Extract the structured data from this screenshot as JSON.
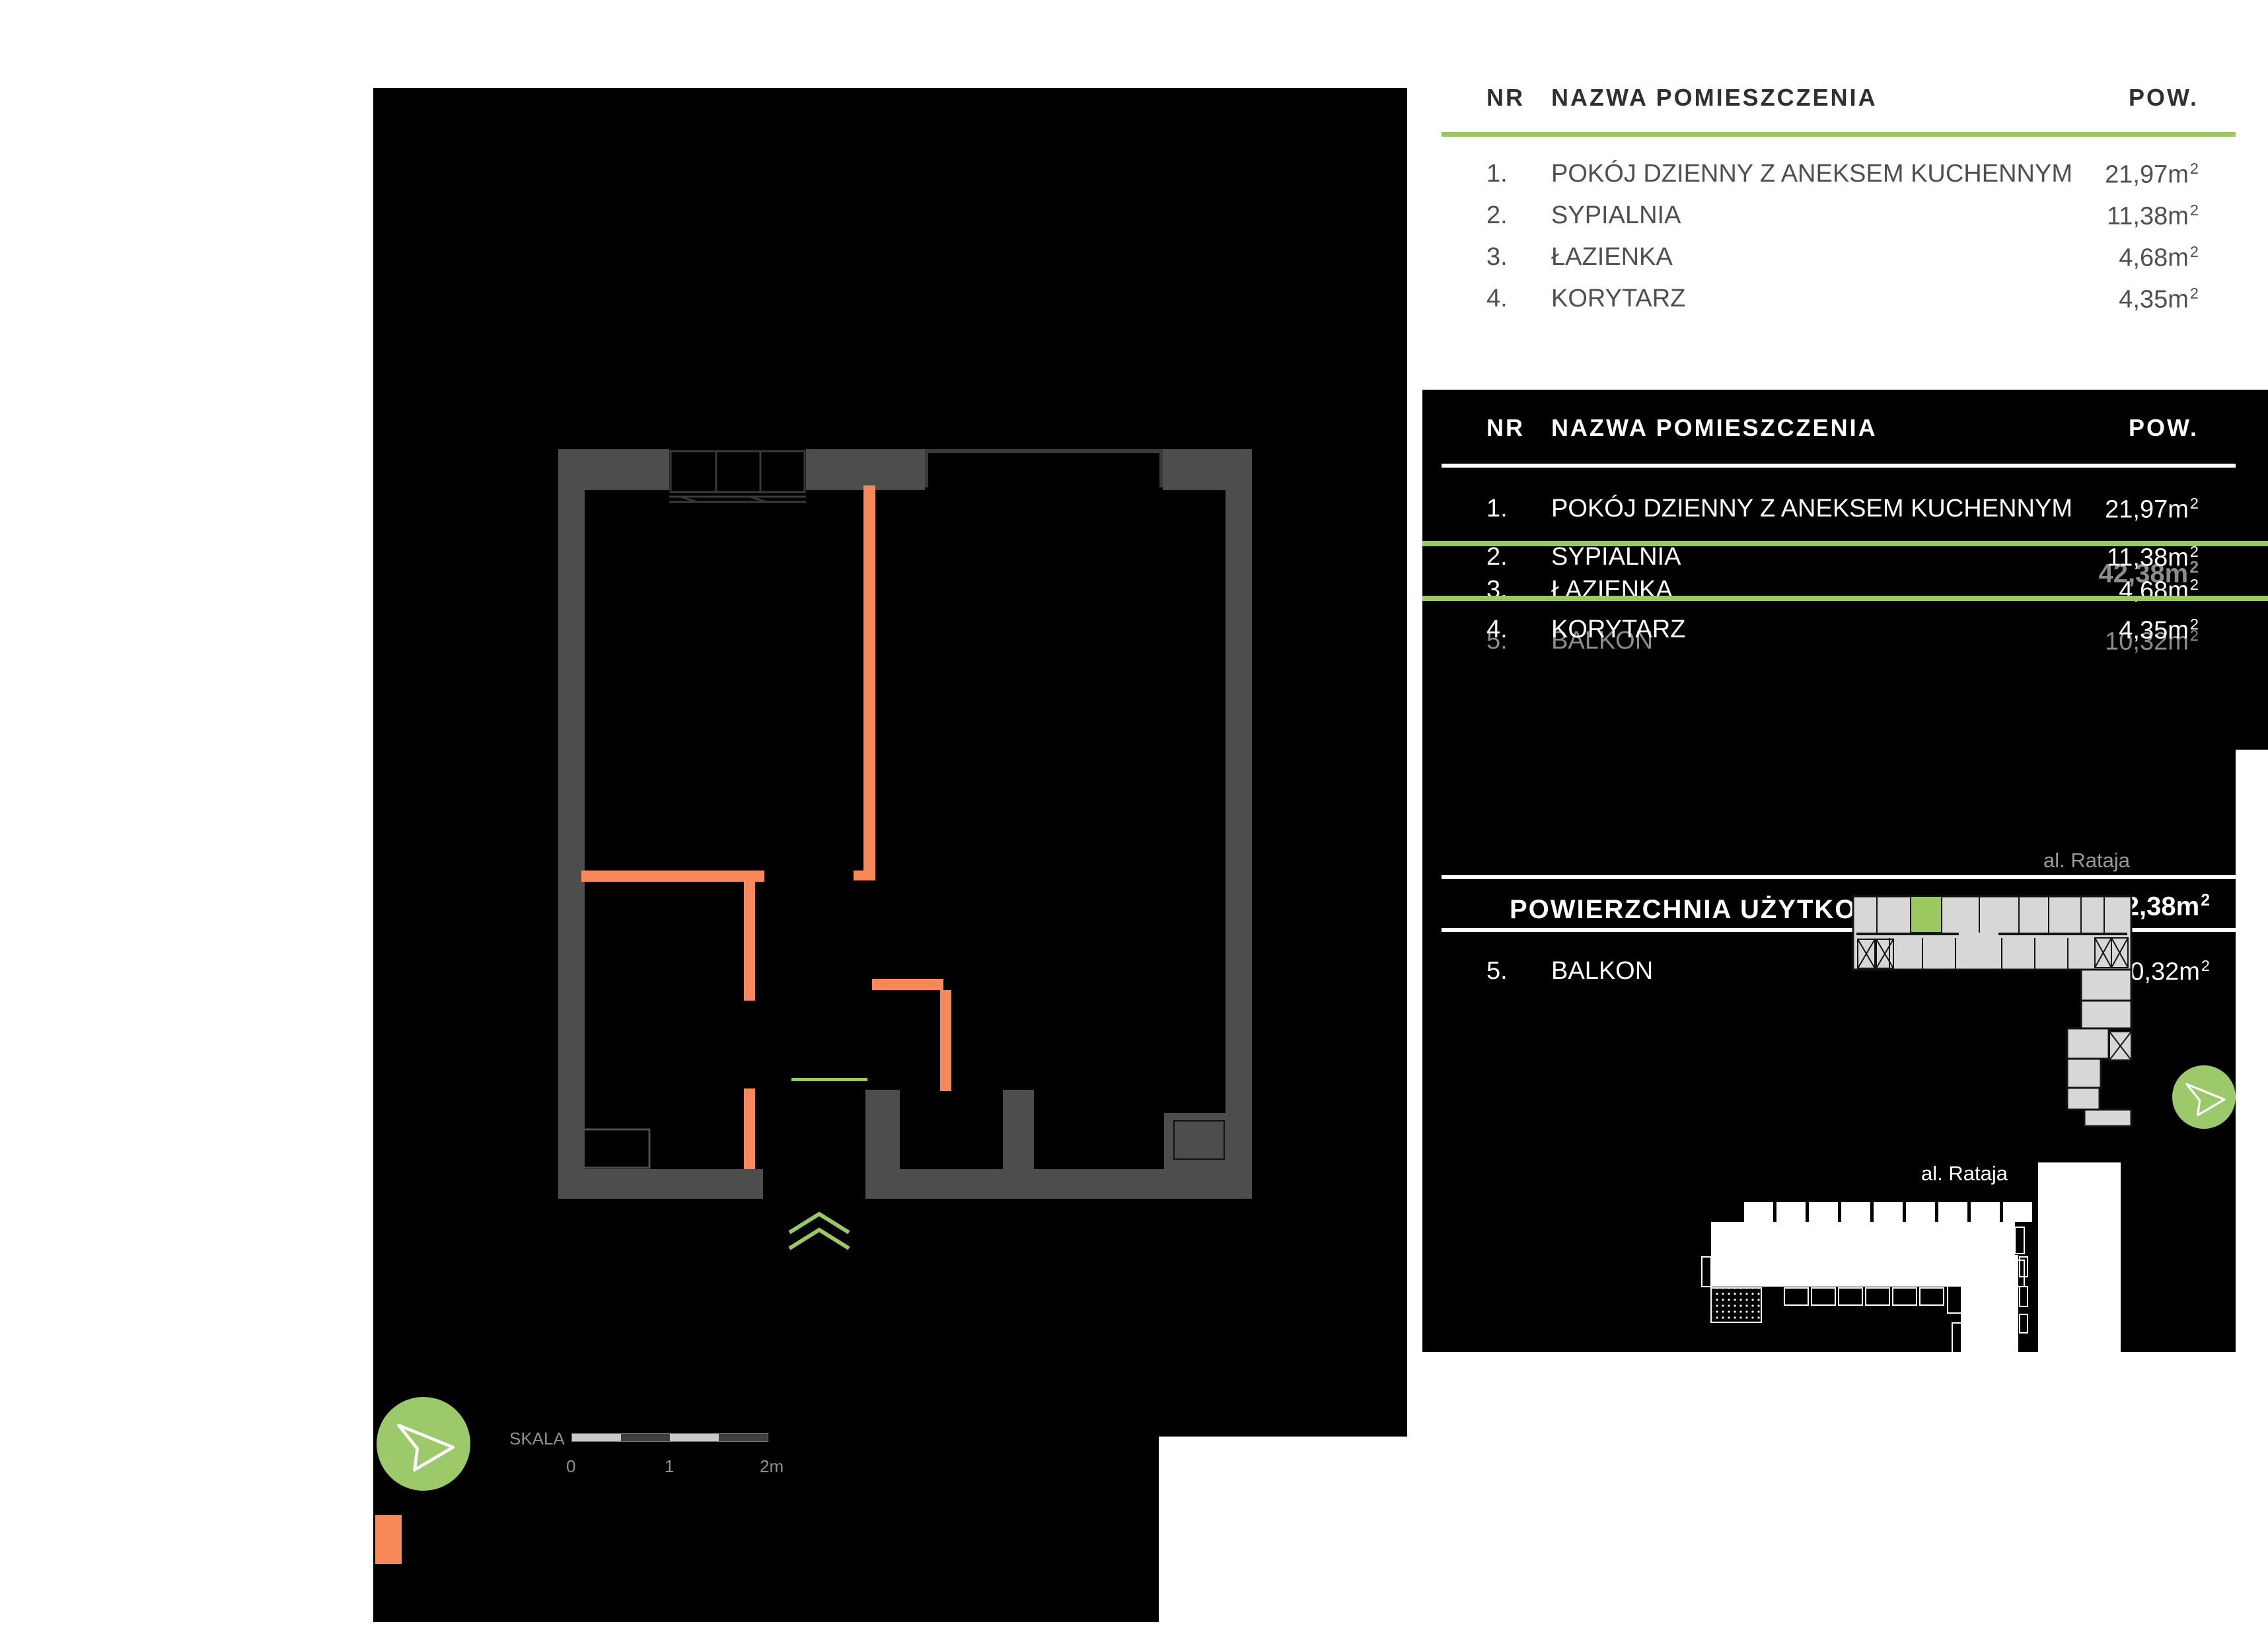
{
  "colors": {
    "page_bg": "#ffffff",
    "panel_bg": "#000000",
    "accent_green": "#9cc862",
    "accent_orange": "#f6885a",
    "wall_gray": "#4d4d4d",
    "site_plan_fill": "#d7d7d7",
    "muted_gray_text": "#9a9a9a",
    "ghost_gray_text": "#8c8c8c"
  },
  "units": {
    "m": "m",
    "sup": "2"
  },
  "legend_light": {
    "header": {
      "nr": "NR",
      "name": "NAZWA POMIESZCZENIA",
      "area": "POW."
    },
    "rows": [
      {
        "nr": "1.",
        "name": "POKÓJ DZIENNY Z ANEKSEM KUCHENNYM",
        "area": "21,97"
      },
      {
        "nr": "2.",
        "name": "SYPIALNIA",
        "area": "11,38"
      },
      {
        "nr": "3.",
        "name": "ŁAZIENKA",
        "area": "4,68"
      },
      {
        "nr": "4.",
        "name": "KORYTARZ",
        "area": "4,35"
      }
    ]
  },
  "legend_dark": {
    "header": {
      "nr": "NR",
      "name": "NAZWA POMIESZCZENIA",
      "area": "POW."
    },
    "rows": [
      {
        "nr": "1.",
        "name": "POKÓJ DZIENNY Z ANEKSEM KUCHENNYM",
        "area": "21,97"
      },
      {
        "nr": "2.",
        "name": "SYPIALNIA",
        "area": "11,38"
      },
      {
        "nr": "3.",
        "name": "ŁAZIENKA",
        "area": "4,68"
      },
      {
        "nr": "4.",
        "name": "KORYTARZ",
        "area": "4,35"
      }
    ],
    "ghost_total": "42,38",
    "ghost_balcony": {
      "nr": "5.",
      "name": "BALKON",
      "area": "10,32"
    },
    "summary": {
      "label": "POWIERZCHNIA UŻYTKOWA",
      "value": "42,38"
    },
    "balcony_row": {
      "nr": "5.",
      "name": "BALKON",
      "area": "10,32"
    }
  },
  "site_plan_upper": {
    "street": "al. Rataja"
  },
  "site_plan_lower": {
    "street": "al. Rataja"
  },
  "scale_bar": {
    "label": "SKALA",
    "tick_0": "0",
    "tick_1": "1",
    "tick_2": "2m"
  }
}
